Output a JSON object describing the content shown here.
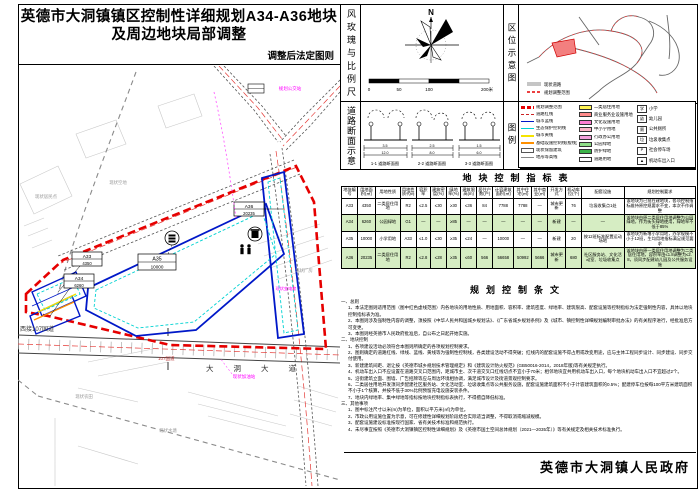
{
  "title": {
    "line1": "英德市大洞镇镇区控制性详细规划A34-A36地块",
    "line2": "及周边地块局部调整",
    "subtitle": "调整后法定图则"
  },
  "colors": {
    "boundary_red": "#e60000",
    "plot_blue": "#0018c8",
    "setback_cyan": "#00d2d2",
    "table_green": "#d6edc3",
    "annotation_magenta": "#ff00ff"
  },
  "panels": {
    "windrose_label": "风玫瑰与比例尺",
    "road_section_label": "道路断面示意",
    "location_label": "区位示意图",
    "legend_label": "图例"
  },
  "windrose": {
    "north": "N",
    "scale_labels": [
      "0",
      "50",
      "100",
      "200米"
    ]
  },
  "road_sections": [
    {
      "caption": "1-1 道路断面图",
      "dim_top": "3.5",
      "dim_bottom": "12.0"
    },
    {
      "caption": "2-2 道路断面图",
      "dim_top": "2.5",
      "dim_bottom": "8.0"
    },
    {
      "caption": "3-3 道路断面图",
      "dim_top": "1.5",
      "dim_bottom": "6.0"
    }
  ],
  "location_map": {
    "mini_legend": [
      {
        "label": "现状道路"
      },
      {
        "label": "规划调整范围"
      }
    ]
  },
  "legend": {
    "lines": [
      {
        "label": "规划调整范围"
      },
      {
        "label": "道路红线"
      },
      {
        "label": "城市蓝线"
      },
      {
        "label": "生态保护控制线"
      },
      {
        "label": "城市黄线"
      },
      {
        "label": "基础设施控制线(橙线)"
      },
      {
        "label": "现状保留建筑"
      },
      {
        "label": "地形等高线"
      }
    ],
    "fills": [
      {
        "label": "二类居住用地",
        "color": "#fff453"
      },
      {
        "label": "商业服务业设施用地",
        "color": "#ff8a8a"
      },
      {
        "label": "文化设施用地",
        "color": "#ff7dd1"
      },
      {
        "label": "中小学用地",
        "color": "#ffb5c8"
      },
      {
        "label": "行政办公用地",
        "color": "#f4a0dc"
      },
      {
        "label": "公园绿地",
        "color": "#8fdf88"
      },
      {
        "label": "防护绿地",
        "color": "#3cb44a"
      },
      {
        "label": "道路用地",
        "color": "#ffffff"
      }
    ],
    "icons": [
      {
        "glyph": "学",
        "label": "小学"
      },
      {
        "glyph": "幼",
        "label": "幼儿园"
      },
      {
        "glyph": "厕",
        "label": "公共厕所"
      },
      {
        "glyph": "垃",
        "label": "垃圾收集点"
      },
      {
        "glyph": "P",
        "label": "社会停车场"
      },
      {
        "glyph": "▲",
        "label": "机动车出入口"
      }
    ]
  },
  "table": {
    "title": "地块控制指标表",
    "headers": [
      "地块编号",
      "用地面积(㎡)",
      "用地性质",
      "用地性质代码",
      "容积率",
      "建筑密度(%)",
      "绿地率(%)",
      "建筑限高(m)",
      "居住户数(户)",
      "计容建筑面积(㎡)",
      "其中住宅(㎡)",
      "其中商业(㎡)",
      "开发方式",
      "机动车位(个)",
      "配套设施",
      "规划控制要求"
    ],
    "rows": [
      {
        "highlight": false,
        "cells": [
          "A33",
          "4350",
          "二类居住用地",
          "R2",
          "≤2.5",
          "≤30",
          "≥30",
          "≤36",
          "84",
          "7788",
          "7788",
          "—",
          "城市更新",
          "76",
          "垃圾收集点1处",
          "该地块为已批在建地块，各项控制指标维持原控规要求不变，本次不作调整"
        ]
      },
      {
        "highlight": true,
        "cells": [
          "A34",
          "6260",
          "公园绿地",
          "G1",
          "—",
          "—",
          "≥85",
          "—",
          "—",
          "—",
          "—",
          "—",
          "新建",
          "—",
          "—",
          "该地块由原二类居住用地调整为公园绿地，作为街头绿地使用，绿地率不低于85%"
        ]
      },
      {
        "highlight": false,
        "cells": [
          "A35",
          "10000",
          "小学用地",
          "A33",
          "≤1.0",
          "≤30",
          "≥35",
          "≤24",
          "—",
          "10000",
          "—",
          "—",
          "新建",
          "20",
          "按12班标准配置运动场地",
          "该地块为新增小学用地，办学规模不小于12班，生均用地指标满足规范要求"
        ]
      },
      {
        "highlight": true,
        "cells": [
          "A36",
          "20235",
          "二类居住用地",
          "R2",
          "≤2.8",
          "≤28",
          "≥35",
          "≤60",
          "566",
          "56658",
          "50992",
          "5666",
          "城市更新",
          "680",
          "社区服务站、文化活动室、垃圾收集点",
          "该地块由原一类居住用地调整为二类居住用地，容积率由≤1.8调整为≤2.8，须同步配建幼儿园及公共服务设施"
        ]
      }
    ]
  },
  "provisions": {
    "title": "规划控制条文",
    "lines": [
      "一、总则",
      "1、本法定图则适用范围（图中红色虚线范围）内各地块的用地性质、用地面积、容积率、建筑密度、绿地率、建筑限高、配套设施等控制指标为法定强制性内容，具体以地块控制指标表为准。",
      "2、本图则涉及强制性内容的调整，须按照《中华人民共和国城乡规划法》、《广东省城乡规划条例》及《城市、镇控制性详细规划编制审批办法》的有关程序进行，经批准后方可变更。",
      "3、本图则经英德市人民政府批准后，自公布之日起开始实施。",
      "二、地块控制",
      "1、各项建设活动必须符合本图则所确定的各项规划控制要求。",
      "2、图则确定的道路红线、绿线、蓝线、黄线等为强制性控制线，各类建设活动不得突破；红线内的配套设施不得占用或改变用途，应与主体工程同步设计、同步建设、同步交付使用。",
      "3、新建建筑间距、退让按《英德市城乡规划技术管理规定》和《建筑设计防火规范》(GB50016-2014，2018年版)等有关规定执行。",
      "4、机动车出入口不应设置在道路交叉口范围内，距城市主、次干道交叉口红线切点不宜小于70米；相邻地块宜共用机动车出入口，每个地块机动车出入口不宜超过2个。",
      "5、沿街建筑立面、围墙、广告招牌等应与周边环境相协调，满足城市设计及街道景观控制要求。",
      "6、二类居住用地开发须同步配建社区服务站、文化活动室、垃圾收集点等公共服务设施，配套设施建筑面积不小于计容建筑面积的0.5%；配建停车位按每100平方米建筑面积不小于1个核算，并按不低于30%比例预留充电设施安装条件。",
      "7、地块内绿地率、集中绿地等指标按地块控制指标表执行，不得擅自降低标准。",
      "三、其他事项",
      "1、图中标注尺寸以米(m)为单位，面积以平方米(㎡)为单位。",
      "2、市政公用设施位置为示意，可在修建性详细规划阶段结合实际适当调整，不得取消或缩减规模。",
      "3、配套设施建设标准按现行国家、省有关技术标准和规范执行。",
      "4、未尽事宜按照《英德市大洞镇镇区控制性详细规划》及《英德市国土空间总体规划（2021—2035年）》等有关规定及相关技术标准执行。"
    ]
  },
  "signature": "英德市大洞镇人民政府",
  "map": {
    "plots": [
      {
        "id": "A33",
        "area": "4350"
      },
      {
        "id": "A34",
        "area": "6260"
      },
      {
        "id": "A35",
        "area": "10000"
      },
      {
        "id": "A36",
        "area": "20235"
      }
    ],
    "roads": {
      "main": "大洞大道",
      "highway": "107国道",
      "west": "西接107国道"
    },
    "annotations": [
      {
        "text": "规划公交站"
      },
      {
        "text": "现状加油站"
      },
      {
        "text": "现状变电房"
      },
      {
        "text": "现状居民点"
      },
      {
        "text": "现状空地"
      },
      {
        "text": "现状厂房"
      },
      {
        "text": "现状农田"
      },
      {
        "text": "现状水塘"
      }
    ]
  }
}
